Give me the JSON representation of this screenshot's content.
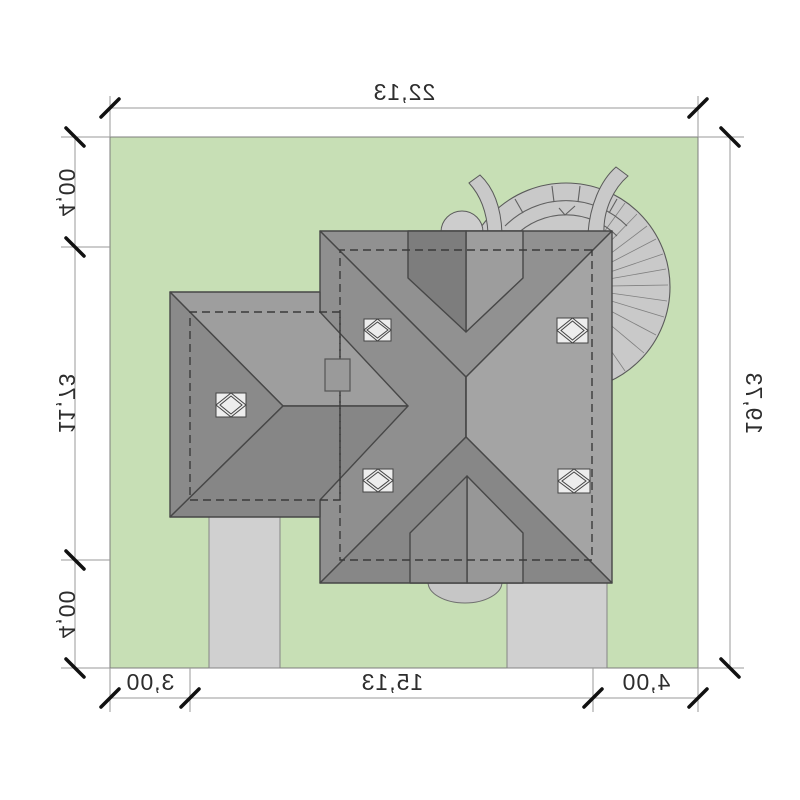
{
  "plan": {
    "dimensions_m": {
      "top_width": "22,13",
      "right_height": "19,73",
      "left_segments": [
        "4,00",
        "11,73",
        "4,00"
      ],
      "bottom_segments": [
        "3,00",
        "15,13",
        "4,00"
      ]
    },
    "colors": {
      "lawn": "#c7dfb5",
      "roof_north": "#919191",
      "roof_south": "#878787",
      "roof_east_light": "#a4a4a4",
      "roof_west": "#8f8f8f",
      "wing_top": "#9e9e9e",
      "wing_side_dark": "#8a8a8a",
      "wing_bottom": "#868686",
      "dormer_dark": "#7d7d7d",
      "dormer_light": "#9d9d9d",
      "dormer_rear_left": "#979797",
      "dormer_rear_right": "#8d8d8d",
      "turret": "#c9c9c9",
      "turret_cap": "#cdcdcd",
      "paving": "#d0d0d0",
      "terrace": "#c6c6c6",
      "skylight": "#ededed",
      "chimney": "#9a9a9a",
      "outline": "#474747",
      "dashed_wall": "#3a3a3a",
      "dim_line": "#9a9a9a",
      "dim_tick": "#111111",
      "dim_text": "#2d2d2d"
    }
  }
}
